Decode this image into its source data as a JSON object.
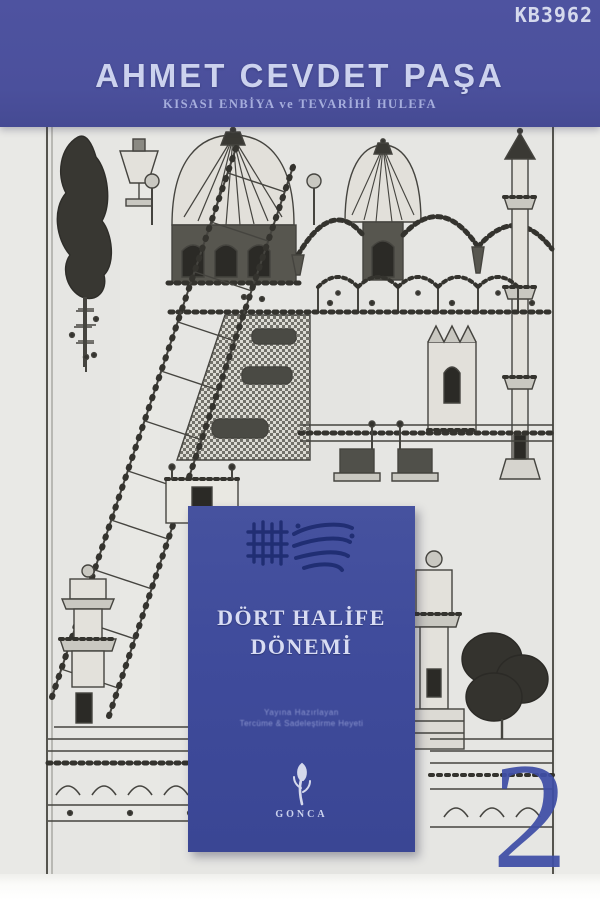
{
  "watermark": {
    "code": "KB3962"
  },
  "header": {
    "author": "AHMET CEVDET PAŞA",
    "series_title": "KISASI ENBİYA ve TEVARİHİ HULEFA"
  },
  "panel": {
    "calligraphy_icon": "arabic-calligraphy",
    "title_line1": "DÖRT HALİFE",
    "title_line2": "DÖNEMİ",
    "credit_line1": "Yayına Hazırlayan",
    "credit_line2": "Tercüme & Sadeleştirme Heyeti",
    "publisher_emblem_icon": "rosebud-calligraphy-emblem",
    "publisher_name": "GONCA"
  },
  "volume_number": "2",
  "illustration": {
    "name": "ottoman-miniature",
    "description": "Black ink Ottoman miniature of a mosque complex with ribbed domes, beaded arcades, checkered wall, minarets, thrones, trees and a long diagonal staircase on parchment"
  },
  "colors": {
    "band_blue": "#4b509c",
    "panel_blue": "#3f4b9b",
    "calligraphy_ink": "#1e2c70",
    "title_text": "#ccd2ee",
    "subtitle_text": "#a6aedd",
    "panel_text": "#d8dcf3",
    "volume_numeral": "#3f4ea6",
    "parchment": "#e6e6e3",
    "drawing_ink": "#45443f",
    "page_bottom": "#fbfbf9"
  }
}
